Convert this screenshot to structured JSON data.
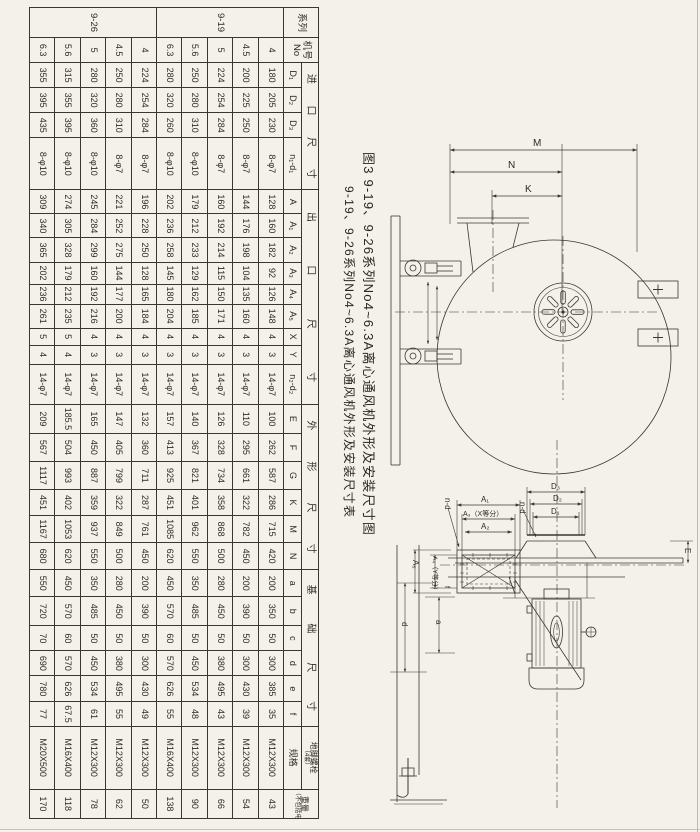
{
  "page": {
    "bg": "#f3f1ea",
    "ink": "#3b372f"
  },
  "captions": {
    "figure_title": "图3  9-19、9-26系列No4~6.3A离心通风机外形及安装尺寸图",
    "table_title": "9-19、9-26系列No4~6.3A离心通风机外形及安装尺寸表"
  },
  "table": {
    "corner": {
      "series": "系列",
      "model": "机号\nNo"
    },
    "col_widths": [
      30,
      25,
      25,
      25,
      25,
      52,
      24,
      24,
      24,
      22,
      20,
      24,
      17,
      19,
      40,
      29,
      28,
      28,
      26,
      27,
      27,
      27,
      29,
      25,
      25,
      26,
      24,
      63,
      29
    ],
    "groups": [
      {
        "label": "进口尺寸",
        "spread": true,
        "cols": [
          "D₁",
          "D₂",
          "D₃",
          "n₁-d₁"
        ]
      },
      {
        "label": "出口尺寸",
        "spread": true,
        "cols": [
          "A",
          "A₁",
          "A₂",
          "A₃",
          "A₄",
          "A₅",
          "X",
          "Y",
          "n₂-d₂"
        ]
      },
      {
        "label": "外形尺寸",
        "spread": true,
        "cols": [
          "E",
          "F",
          "G",
          "K",
          "M",
          "N"
        ]
      },
      {
        "label": "基础尺寸",
        "spread": true,
        "cols": [
          "a",
          "b",
          "c",
          "d",
          "e",
          "f"
        ]
      },
      {
        "label": "地脚螺栓",
        "sublabel": "（4套）",
        "cols": [
          "规格"
        ]
      },
      {
        "label": "重量",
        "sublabel": "（不包括电机）",
        "cols": null
      }
    ],
    "series": [
      {
        "name": "9-19",
        "rows": [
          {
            "no": "4",
            "values": [
              "180",
              "205",
              "230",
              "8-φ7",
              "128",
              "160",
              "182",
              "92",
              "126",
              "148",
              "4",
              "3",
              "14-φ7",
              "100",
              "262",
              "587",
              "286",
              "715",
              "420",
              "200",
              "350",
              "50",
              "300",
              "385",
              "35",
              "M12X300",
              "43"
            ]
          },
          {
            "no": "4.5",
            "values": [
              "200",
              "225",
              "250",
              "8-φ7",
              "144",
              "176",
              "198",
              "104",
              "135",
              "160",
              "4",
              "3",
              "14-φ7",
              "110",
              "295",
              "661",
              "322",
              "782",
              "450",
              "200",
              "390",
              "50",
              "300",
              "430",
              "39",
              "M12X300",
              "54"
            ]
          },
          {
            "no": "5",
            "values": [
              "224",
              "254",
              "284",
              "8-φ7",
              "160",
              "192",
              "214",
              "115",
              "150",
              "171",
              "4",
              "3",
              "14-φ7",
              "126",
              "328",
              "734",
              "358",
              "868",
              "500",
              "280",
              "450",
              "50",
              "380",
              "495",
              "43",
              "M12X300",
              "66"
            ]
          },
          {
            "no": "5.6",
            "values": [
              "250",
              "280",
              "310",
              "8-φ10",
              "179",
              "212",
              "233",
              "129",
              "162",
              "185",
              "4",
              "3",
              "14-φ7",
              "140",
              "367",
              "821",
              "401",
              "962",
              "550",
              "350",
              "485",
              "50",
              "450",
              "534",
              "48",
              "M12X300",
              "90"
            ]
          },
          {
            "no": "6.3",
            "values": [
              "280",
              "320",
              "260",
              "8-φ10",
              "202",
              "236",
              "258",
              "145",
              "180",
              "204",
              "4",
              "3",
              "14-φ7",
              "157",
              "413",
              "925",
              "451",
              "1085",
              "620",
              "450",
              "570",
              "60",
              "570",
              "626",
              "55",
              "M16X400",
              "138"
            ]
          }
        ]
      },
      {
        "name": "9-26",
        "rows": [
          {
            "no": "4",
            "values": [
              "224",
              "254",
              "284",
              "8-φ7",
              "196",
              "228",
              "250",
              "128",
              "165",
              "184",
              "4",
              "3",
              "14-φ7",
              "132",
              "360",
              "711",
              "287",
              "761",
              "450",
              "200",
              "390",
              "50",
              "300",
              "430",
              "49",
              "M12X300",
              "50"
            ]
          },
          {
            "no": "4.5",
            "values": [
              "250",
              "280",
              "310",
              "8-φ7",
              "221",
              "252",
              "275",
              "144",
              "177",
              "200",
              "4",
              "3",
              "14-φ7",
              "147",
              "405",
              "799",
              "322",
              "849",
              "500",
              "280",
              "450",
              "50",
              "380",
              "495",
              "55",
              "M12X300",
              "62"
            ]
          },
          {
            "no": "5",
            "values": [
              "280",
              "320",
              "360",
              "8-φ10",
              "245",
              "284",
              "299",
              "160",
              "192",
              "216",
              "4",
              "3",
              "14-φ7",
              "165",
              "450",
              "887",
              "359",
              "937",
              "550",
              "350",
              "485",
              "50",
              "450",
              "534",
              "61",
              "M12X300",
              "78"
            ]
          },
          {
            "no": "5.6",
            "values": [
              "315",
              "355",
              "395",
              "8-φ10",
              "274",
              "305",
              "328",
              "179",
              "212",
              "235",
              "5",
              "4",
              "14-φ7",
              "185.5",
              "504",
              "993",
              "402",
              "1053",
              "620",
              "450",
              "570",
              "60",
              "570",
              "626",
              "67.5",
              "M16X400",
              "118"
            ]
          },
          {
            "no": "6.3",
            "values": [
              "355",
              "395",
              "435",
              "8-φ10",
              "309",
              "340",
              "365",
              "202",
              "236",
              "261",
              "5",
              "4",
              "14-φ7",
              "209",
              "567",
              "1117",
              "451",
              "1167",
              "680",
              "550",
              "720",
              "70",
              "690",
              "780",
              "77",
              "M20X500",
              "170"
            ]
          }
        ]
      }
    ]
  },
  "figure": {
    "m": "M",
    "n": "N",
    "k": "K",
    "d3": "D₃",
    "d2": "D₂",
    "d1": "D₁",
    "a1": "A₁",
    "a3x": "A₃（X等分）",
    "a2": "A₂",
    "a5": "A₅",
    "a4y": "A₄（Y等分）",
    "f": "f",
    "nd_left": "n-d",
    "nd_right": "n-d",
    "e_dim": "E",
    "a_dim": "a",
    "d_dim": "d"
  }
}
